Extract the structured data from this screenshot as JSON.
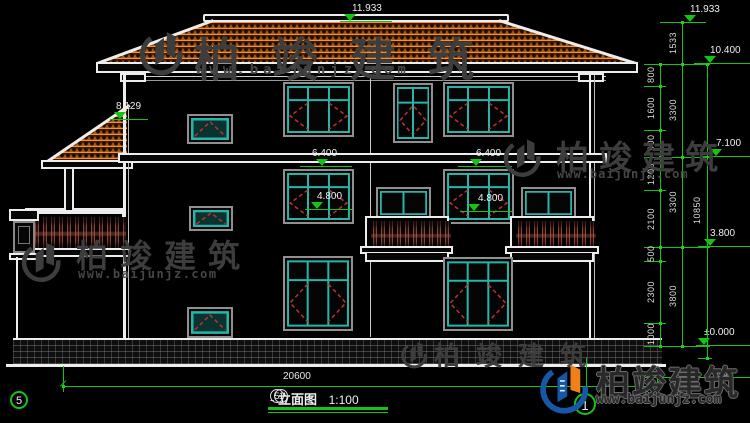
{
  "watermark": {
    "company": "柏竣建筑",
    "website": "www.baijunjz.com"
  },
  "elevations": {
    "ridge_center": "11.933",
    "ridge_right": "11.933",
    "eave": "10.400",
    "porch_roof": "8.129",
    "floor3": "7.100",
    "floor2": "3.800",
    "ground": "±0.000",
    "head_left": "6.400",
    "head_right": "6.400",
    "sill_left": "4.800",
    "sill_right": "4.800"
  },
  "dimensions": {
    "segments": [
      "800",
      "1600",
      "900",
      "1200",
      "2100",
      "500",
      "2300",
      "1000"
    ],
    "floors": [
      "1533",
      "3300",
      "3300",
      "3800"
    ],
    "total_height": "10850",
    "total_width": "20600",
    "plinth": "450"
  },
  "grid": {
    "left_bubble": "5",
    "right_bubble": "1"
  },
  "title_block": {
    "axis_start": "5",
    "separator": "-",
    "axis_end": "1",
    "name": "立面图",
    "scale": "1:100"
  }
}
